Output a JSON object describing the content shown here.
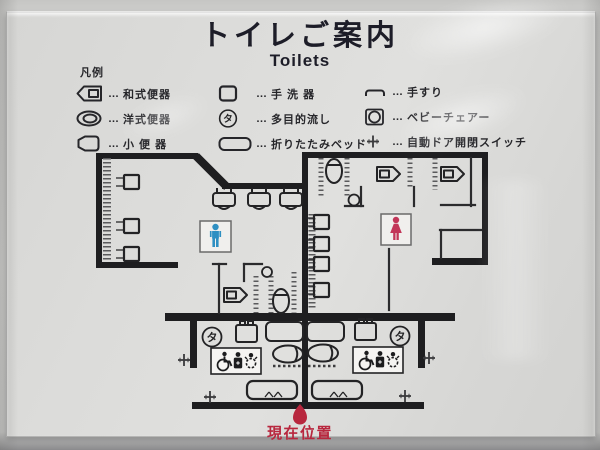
{
  "sign": {
    "title": "トイレご案内",
    "subtitle": "Toilets",
    "legend": {
      "heading": "凡例",
      "separator": "…",
      "items": [
        {
          "icon": "squat-toilet-icon",
          "label": "和式便器"
        },
        {
          "icon": "western-toilet-icon",
          "label": "洋式便器"
        },
        {
          "icon": "urinal-icon",
          "label": "小 便 器"
        },
        {
          "icon": "hand-wash-basin-icon",
          "label": "手 洗 器"
        },
        {
          "icon": "multipurpose-sink-icon",
          "label": "多目的流し"
        },
        {
          "icon": "folding-bed-icon",
          "label": "折りたたみベッド"
        },
        {
          "icon": "handrail-icon",
          "label": "手すり"
        },
        {
          "icon": "baby-chair-icon",
          "label": "ベビーチェアー"
        },
        {
          "icon": "auto-door-switch-icon",
          "label": "自動ドア開閉スイッチ"
        }
      ]
    },
    "map": {
      "mens_room_color": "#2e8fc2",
      "womens_room_color": "#c23558",
      "multipurpose_sink_mark": "タ",
      "current_location": {
        "label": "現在位置",
        "color": "#b8273e"
      }
    }
  }
}
